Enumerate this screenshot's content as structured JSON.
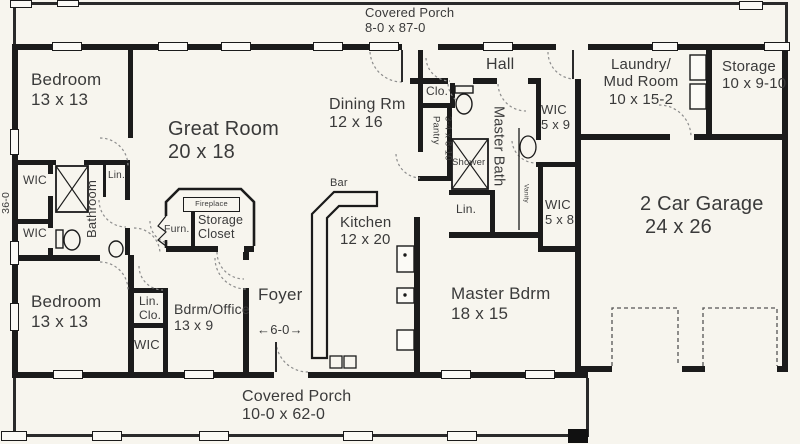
{
  "porches": {
    "top": {
      "name": "Covered Porch",
      "dims": "8-0 x 87-0"
    },
    "bottom": {
      "name": "Covered Porch",
      "dims": "10-0 x 62-0"
    }
  },
  "dimensions": {
    "overall_depth": "36-0",
    "foyer_opening": "←6-0→"
  },
  "rooms": {
    "bedroom_top": {
      "name": "Bedroom",
      "dims": "13 x 13"
    },
    "bedroom_bot": {
      "name": "Bedroom",
      "dims": "13 x 13"
    },
    "great_room": {
      "name": "Great Room",
      "dims": "20 x 18"
    },
    "dining": {
      "name": "Dining Rm",
      "dims": "12 x 16"
    },
    "hall": {
      "name": "Hall"
    },
    "laundry": {
      "line1": "Laundry/",
      "line2": "Mud Room",
      "dims": "10 x 15-2"
    },
    "storage": {
      "name": "Storage",
      "dims": "10 x 9-10"
    },
    "garage": {
      "name": "2 Car Garage",
      "dims": "24 x 26"
    },
    "master_bdrm": {
      "name": "Master Bdrm",
      "dims": "18 x 15"
    },
    "kitchen": {
      "name": "Kitchen",
      "dims": "12 x 20"
    },
    "bdrm_office": {
      "name": "Bdrm/Office",
      "dims": "13 x 9"
    },
    "foyer": {
      "name": "Foyer"
    },
    "bathroom": {
      "name": "Bathroom"
    },
    "master_bath": {
      "name": "Master Bath"
    }
  },
  "closets": {
    "wic_left_upper": "WIC",
    "wic_left_lower": "WIC",
    "lin_bath": "Lin.",
    "lin_clo": {
      "line1": "Lin.",
      "line2": "Clo."
    },
    "wic_office": "WIC",
    "clo_hall": "Clo.",
    "pantry": {
      "name": "Pantry",
      "dims": "3-4 x 8-10"
    },
    "wic_master_1": {
      "name": "WIC",
      "dims": "5 x 9"
    },
    "wic_master_2": {
      "name": "WIC",
      "dims": "5 x 8"
    },
    "lin_master": "Lin."
  },
  "fixtures": {
    "shower": "Shower",
    "vanity": "Vanity",
    "bar": "Bar",
    "fireplace": "Fireplace",
    "furnace": "Furn.",
    "storage_closet": {
      "line1": "Storage",
      "line2": "Closet"
    }
  },
  "colors": {
    "wall": "#1b1b1b",
    "paper": "#f7f5ee",
    "text": "#3a3a3a"
  }
}
